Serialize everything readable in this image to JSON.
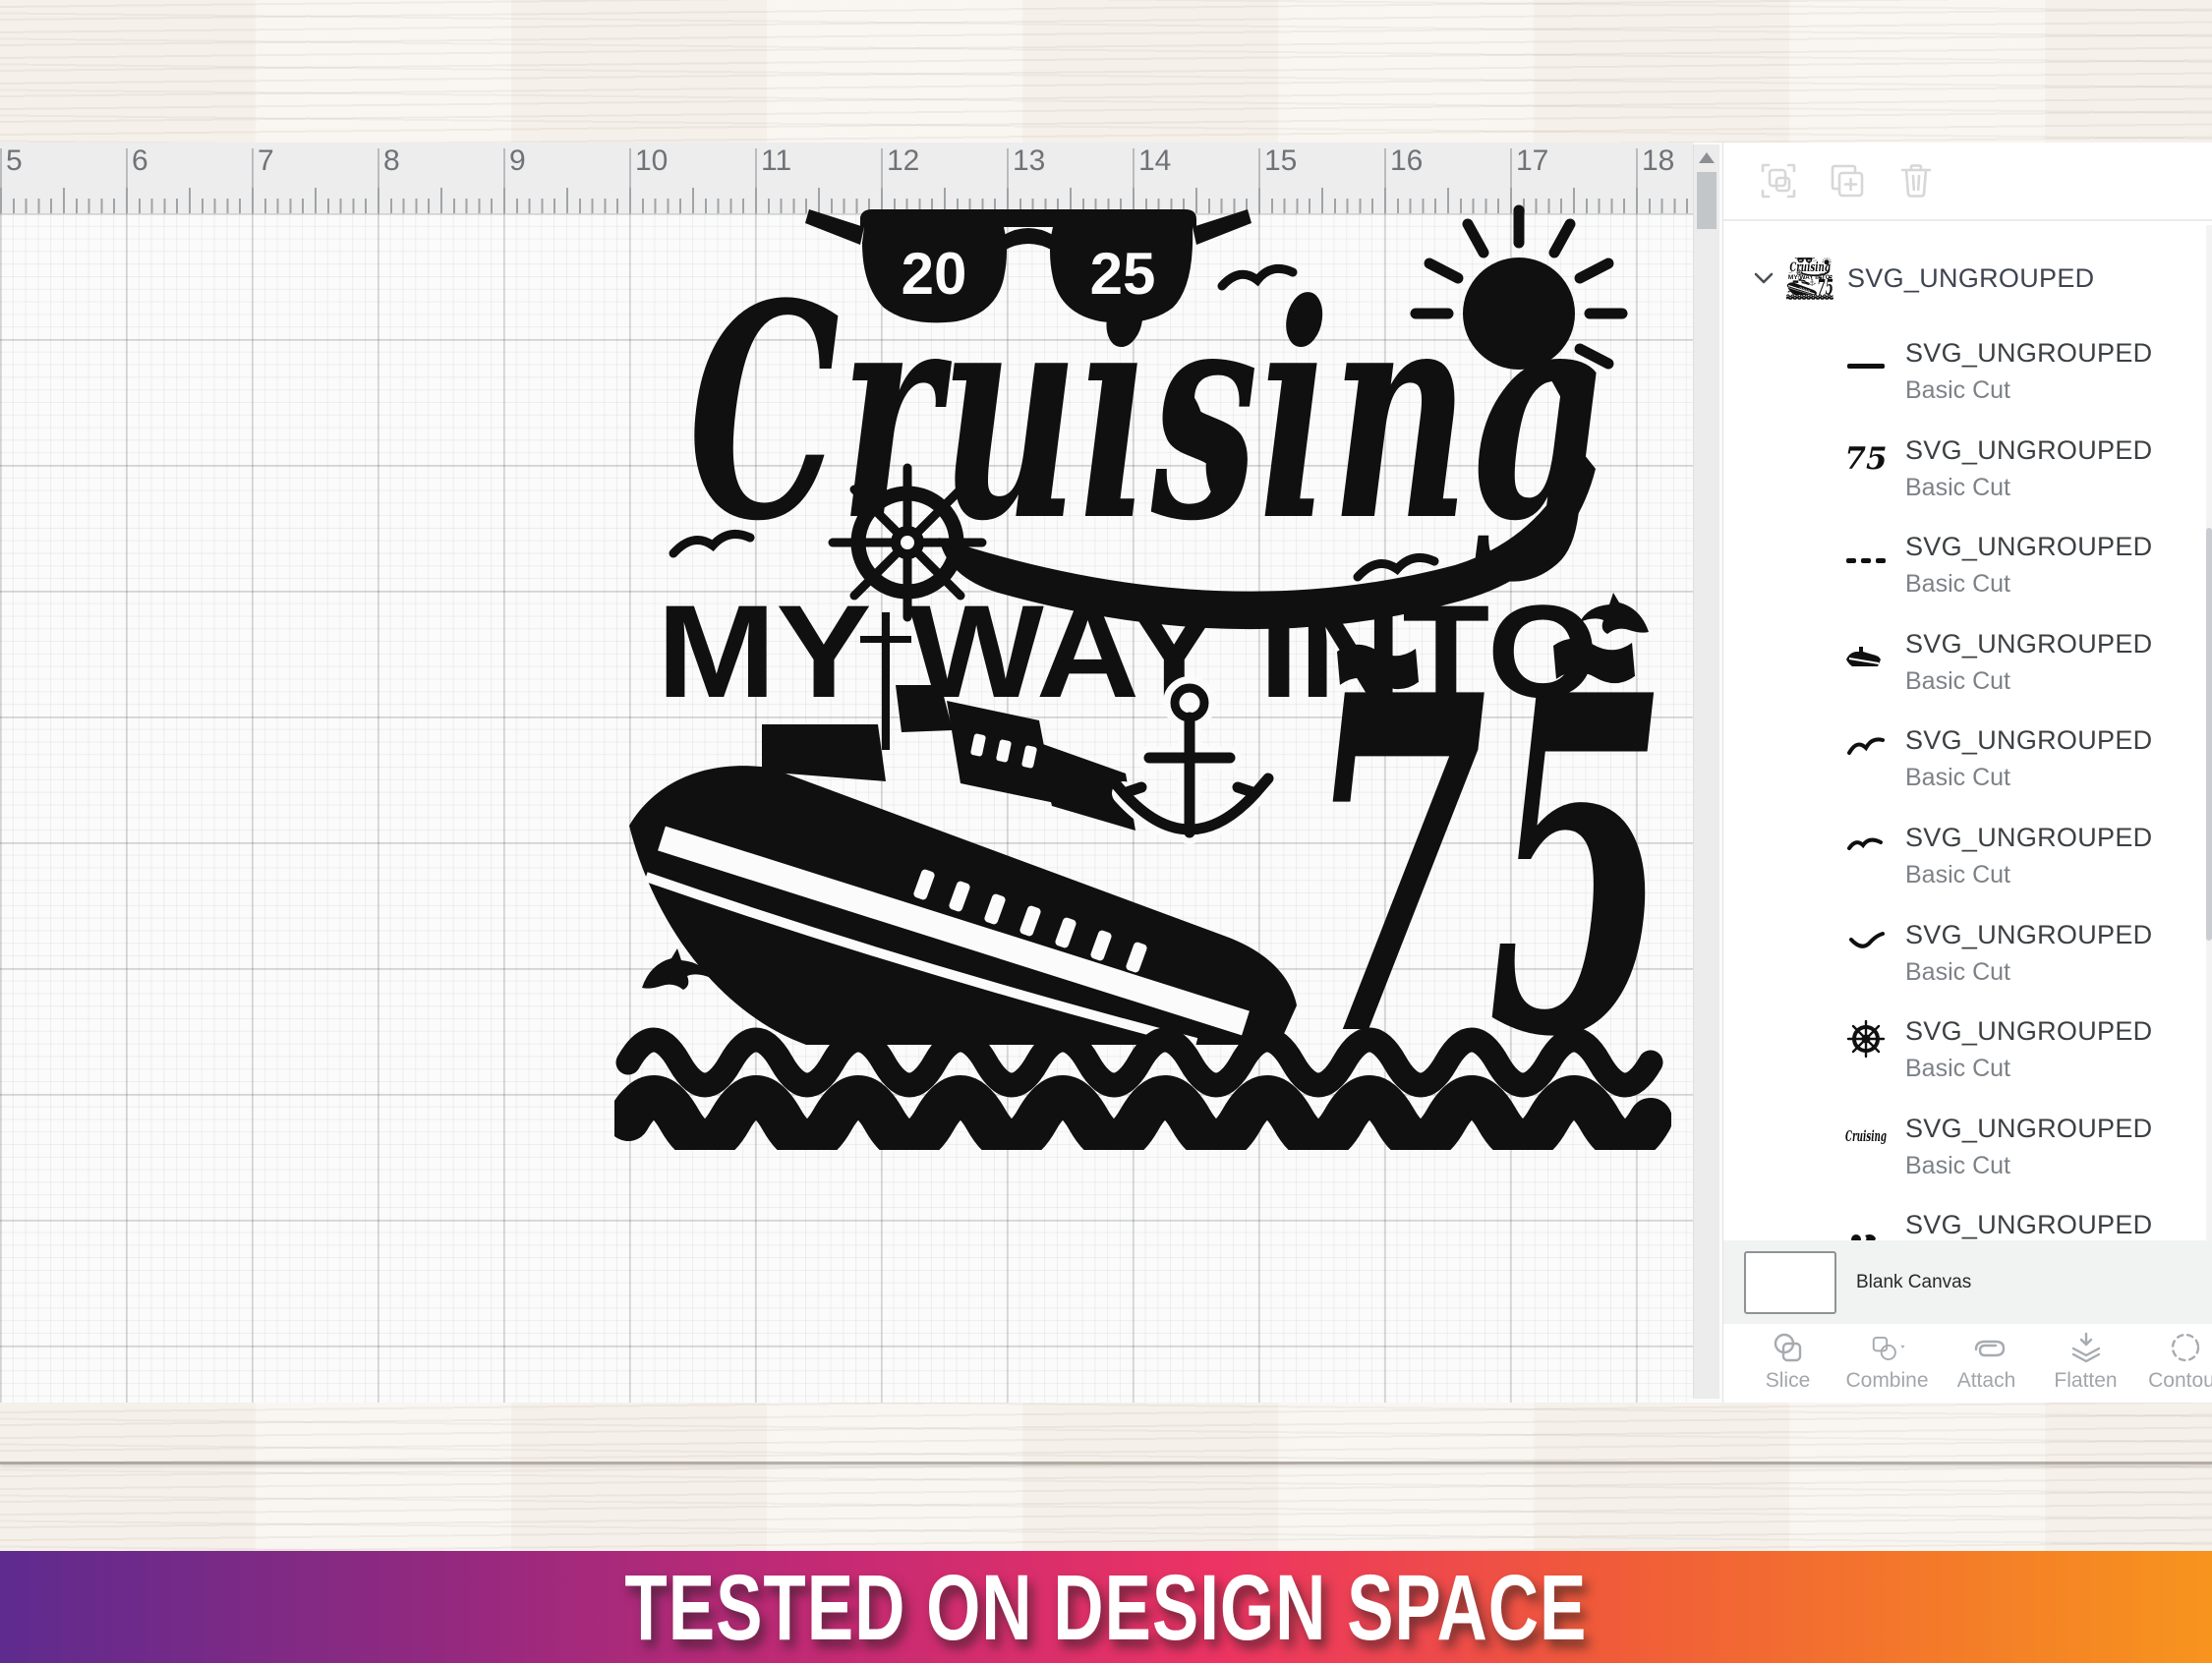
{
  "canvas": {
    "ruler": {
      "numbers": [
        "5",
        "6",
        "7",
        "8",
        "9",
        "10",
        "11",
        "12",
        "13",
        "14",
        "15",
        "16",
        "17",
        "18"
      ]
    },
    "design": {
      "year_left": "20",
      "year_right": "25",
      "title_script": "Cruising",
      "title_line2": "MY WAY INTO",
      "number": "75",
      "elements": [
        "sunglasses",
        "sun",
        "seagulls",
        "ship-wheel",
        "cruise-ship",
        "anchor",
        "flags",
        "waves",
        "dolphins"
      ],
      "color": "#101010"
    }
  },
  "panel": {
    "header_icons": [
      {
        "name": "focus-select-icon"
      },
      {
        "name": "duplicate-icon"
      },
      {
        "name": "trash-icon"
      }
    ],
    "group": {
      "title": "SVG_UNGROUPED"
    },
    "layers": [
      {
        "title": "SVG_UNGROUPED",
        "subtitle": "Basic Cut",
        "thumb": "line"
      },
      {
        "title": "SVG_UNGROUPED",
        "subtitle": "Basic Cut",
        "thumb": "number-75"
      },
      {
        "title": "SVG_UNGROUPED",
        "subtitle": "Basic Cut",
        "thumb": "dashed-line"
      },
      {
        "title": "SVG_UNGROUPED",
        "subtitle": "Basic Cut",
        "thumb": "ship"
      },
      {
        "title": "SVG_UNGROUPED",
        "subtitle": "Basic Cut",
        "thumb": "bird"
      },
      {
        "title": "SVG_UNGROUPED",
        "subtitle": "Basic Cut",
        "thumb": "bird"
      },
      {
        "title": "SVG_UNGROUPED",
        "subtitle": "Basic Cut",
        "thumb": "bird"
      },
      {
        "title": "SVG_UNGROUPED",
        "subtitle": "Basic Cut",
        "thumb": "ship-wheel"
      },
      {
        "title": "SVG_UNGROUPED",
        "subtitle": "Basic Cut",
        "thumb": "cruising-script"
      },
      {
        "title": "SVG_UNGROUPED",
        "subtitle": "Basic Cut",
        "thumb": "partial-shape"
      }
    ],
    "blank_canvas": {
      "label": "Blank Canvas"
    },
    "actions": [
      {
        "label": "Slice",
        "icon": "slice-icon"
      },
      {
        "label": "Combine",
        "icon": "combine-icon"
      },
      {
        "label": "Attach",
        "icon": "attach-icon"
      },
      {
        "label": "Flatten",
        "icon": "flatten-icon"
      },
      {
        "label": "Contour",
        "icon": "contour-icon"
      }
    ]
  },
  "banner": {
    "text": "TESTED ON DESIGN SPACE",
    "gradient": [
      "#5e2b8e",
      "#ec3363",
      "#f7941d"
    ]
  }
}
